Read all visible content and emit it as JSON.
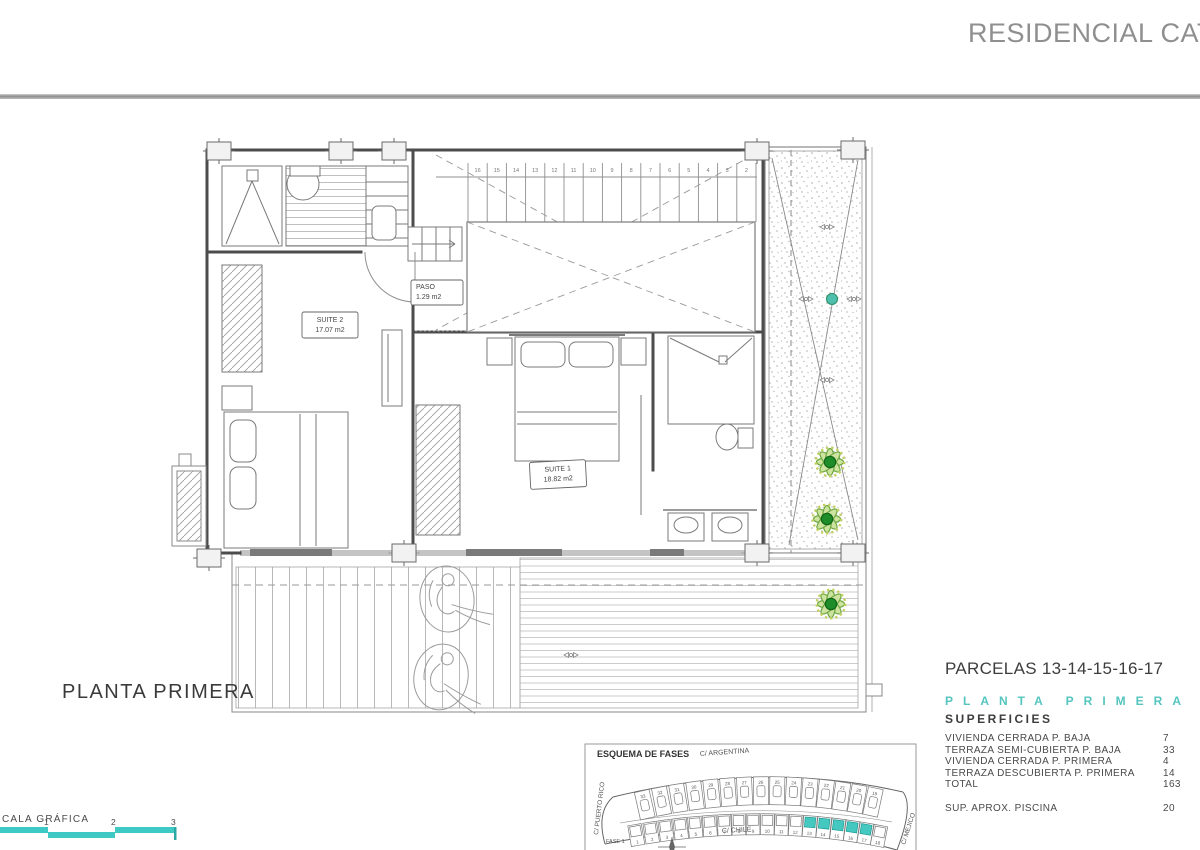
{
  "header": {
    "title": "RESIDENCIAL CATAL"
  },
  "drawing": {
    "floor_title": "PLANTA PRIMERA",
    "rooms": [
      {
        "name": "SUITE 2",
        "area": "17.07 m2"
      },
      {
        "name": "PASO",
        "area": "1.29 m2"
      },
      {
        "name": "SUITE 1",
        "area": "18.82 m2"
      }
    ],
    "stair_numbers": [
      "16",
      "15",
      "14",
      "13",
      "12",
      "11",
      "10",
      "9",
      "8",
      "7",
      "6",
      "5",
      "4",
      "3",
      "2"
    ]
  },
  "scale_bar": {
    "label": "CALA GRÁFICA",
    "ticks": [
      "1",
      "2",
      "3"
    ],
    "color": "#3ec9c5"
  },
  "site_map": {
    "title": "ESQUEMA DE FASES",
    "streets": {
      "top": "C/ ARGENTINA",
      "bottom": "C/ CHILE",
      "left": "C/ PUERTO RICO",
      "right": "C/ MEJICO"
    },
    "phase_label": "FASE 1",
    "top_row_numbers": [
      "33",
      "32",
      "31",
      "30",
      "29",
      "28",
      "27",
      "26",
      "25",
      "24",
      "23",
      "22",
      "21",
      "20",
      "19"
    ],
    "bottom_row_numbers": [
      "1",
      "2",
      "3",
      "4",
      "5",
      "6",
      "7",
      "8",
      "9",
      "10",
      "11",
      "12",
      "13",
      "14",
      "15",
      "16",
      "17",
      "18"
    ],
    "highlighted": [
      "13",
      "14",
      "15",
      "16",
      "17"
    ],
    "highlight_color": "#45c8c0"
  },
  "info_panel": {
    "parcels_title": "PARCELAS 13-14-15-16-17",
    "floor_label": "PLANTA PRIMERA",
    "surfaces_title": "SUPERFICIES",
    "rows": [
      {
        "label": "VIVIENDA CERRADA P. BAJA",
        "value": "7"
      },
      {
        "label": "TERRAZA SEMI-CUBIERTA P. BAJA",
        "value": "33"
      },
      {
        "label": "VIVIENDA CERRADA P. PRIMERA",
        "value": "4"
      },
      {
        "label": "TERRAZA DESCUBIERTA P. PRIMERA",
        "value": "14"
      },
      {
        "label": "TOTAL",
        "value": "163"
      }
    ],
    "pool_label": "SUP. APROX. PISCINA",
    "pool_value": "20"
  },
  "colors": {
    "teal": "#3ec9c5",
    "plant_green": "#1e8c28",
    "line_dark": "#4c4c4c",
    "line_mid": "#7a7a7a",
    "header_gray": "#8f8f8f"
  }
}
